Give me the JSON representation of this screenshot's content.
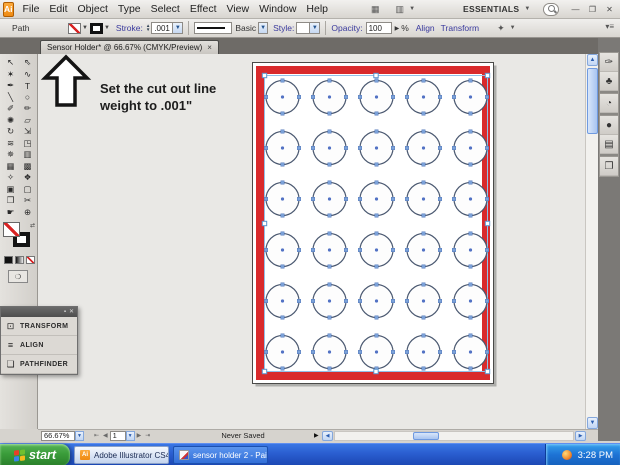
{
  "theme": {
    "chrome": "#d6d3ce",
    "tab_strip": "#6e6b67",
    "canvas_bg": "#e9e8e5",
    "link_purple": "#3a3a9e",
    "taskbar_blue": "#2a5ed0",
    "start_green": "#3a9c3a",
    "artboard_border_red": "#d92a2c",
    "selection_blue": "#92c0e8"
  },
  "window_controls": {
    "minimize": "—",
    "restore": "❐",
    "close": "✕"
  },
  "menu_bar": {
    "logo_text": "Ai",
    "items": [
      "File",
      "Edit",
      "Object",
      "Type",
      "Select",
      "Effect",
      "View",
      "Window",
      "Help"
    ],
    "bridge_icon_glyph": "▦",
    "arrange_icon_glyph": "▥",
    "workspace_label": "ESSENTIALS",
    "caret_glyph": "▼"
  },
  "control_bar": {
    "selection_type_label": "Path",
    "stroke_label": "Stroke:",
    "stroke_weight_value": ".001",
    "brush_name": "Basic",
    "style_label": "Style:",
    "opacity_label": "Opacity:",
    "opacity_value": "100",
    "opacity_arrow": "▶",
    "opacity_unit": "%",
    "align_label": "Align",
    "transform_label": "Transform",
    "select_similar_glyph": "✦",
    "flyout_glyph": "▾≡"
  },
  "document_tab": {
    "title": "Sensor Holder* @ 66.67% (CMYK/Preview)",
    "close_glyph": "×"
  },
  "dock_collapse_glyph": "◄◄",
  "annotation": {
    "line1": "Set the cut out line",
    "line2": "weight to .001\""
  },
  "toolbar": {
    "tools": [
      {
        "name": "selection-tool",
        "glyph": "↖"
      },
      {
        "name": "direct-selection-tool",
        "glyph": "⇖"
      },
      {
        "name": "magic-wand-tool",
        "glyph": "✶"
      },
      {
        "name": "lasso-tool",
        "glyph": "∿"
      },
      {
        "name": "pen-tool",
        "glyph": "✒"
      },
      {
        "name": "type-tool",
        "glyph": "T"
      },
      {
        "name": "line-segment-tool",
        "glyph": "╲"
      },
      {
        "name": "ellipse-tool",
        "glyph": "○"
      },
      {
        "name": "paintbrush-tool",
        "glyph": "✐"
      },
      {
        "name": "pencil-tool",
        "glyph": "✏"
      },
      {
        "name": "blob-brush-tool",
        "glyph": "✺"
      },
      {
        "name": "eraser-tool",
        "glyph": "▱"
      },
      {
        "name": "rotate-tool",
        "glyph": "↻"
      },
      {
        "name": "scale-tool",
        "glyph": "⇲"
      },
      {
        "name": "warp-tool",
        "glyph": "≋"
      },
      {
        "name": "free-transform-tool",
        "glyph": "◳"
      },
      {
        "name": "symbol-sprayer-tool",
        "glyph": "✵"
      },
      {
        "name": "graph-tool",
        "glyph": "▥"
      },
      {
        "name": "mesh-tool",
        "glyph": "▦"
      },
      {
        "name": "gradient-tool",
        "glyph": "▩"
      },
      {
        "name": "eyedropper-tool",
        "glyph": "✧"
      },
      {
        "name": "blend-tool",
        "glyph": "❖"
      },
      {
        "name": "live-paint-bucket-tool",
        "glyph": "▣"
      },
      {
        "name": "live-paint-selection-tool",
        "glyph": "▢"
      },
      {
        "name": "artboard-tool",
        "glyph": "❒"
      },
      {
        "name": "slice-tool",
        "glyph": "✂"
      },
      {
        "name": "hand-tool",
        "glyph": "☛"
      },
      {
        "name": "zoom-tool",
        "glyph": "⊕"
      }
    ]
  },
  "right_dock": {
    "icons": [
      {
        "name": "brushes-icon",
        "glyph": "✑",
        "gap_after": false
      },
      {
        "name": "symbols-icon",
        "glyph": "♣",
        "gap_after": true
      },
      {
        "name": "color-guide-icon",
        "glyph": "◔",
        "gap_after": true
      },
      {
        "name": "color-icon",
        "glyph": "●",
        "gap_after": false
      },
      {
        "name": "swatches-icon",
        "glyph": "▤",
        "gap_after": true
      },
      {
        "name": "layers-icon",
        "glyph": "❐",
        "gap_after": false
      }
    ]
  },
  "floating_panel": {
    "minimize_glyph": "▪",
    "close_glyph": "✕",
    "items": [
      {
        "name": "transform",
        "label": "TRANSFORM",
        "glyph": "⊡"
      },
      {
        "name": "align",
        "label": "ALIGN",
        "glyph": "≡"
      },
      {
        "name": "pathfinder",
        "label": "PATHFINDER",
        "glyph": "❏"
      }
    ]
  },
  "status_bar": {
    "zoom_value": "66.67%",
    "first_glyph": "⇤",
    "prev_glyph": "◀",
    "artboard_value": "1",
    "next_glyph": "▶",
    "last_glyph": "⇥",
    "save_status": "Never Saved",
    "status_flyout_glyph": "▶"
  },
  "artboard": {
    "rows": 6,
    "cols": 5,
    "start_x": 282.5,
    "start_y": 97,
    "dx": 47,
    "dy": 51,
    "radius": 16.5,
    "page": {
      "x": 214.5,
      "y": 8.5,
      "w": 241,
      "h": 321
    },
    "red_rect": {
      "x": 222,
      "y": 16,
      "w": 226,
      "h": 306,
      "stroke_width": 8
    },
    "selection_rect": {
      "x": 226.5,
      "y": 21.5,
      "w": 223,
      "h": 296
    },
    "circle_stroke": "#4a5870",
    "anchor_fill": "#7ca3da",
    "anchor_stroke": "#4f74b8",
    "center_fill": "#5272c4",
    "selection_color": "#92c0e8",
    "handle_stroke": "#5b93cc",
    "border_color": "#d92a2c",
    "page_outline": "#4a4a48"
  },
  "taskbar": {
    "start_label": "start",
    "illustrator_button_label": "Adobe Illustrator CS4...",
    "illustrator_icon_text": "Ai",
    "paint_button_label": "sensor holder 2 - Paint",
    "clock": "3:28 PM"
  }
}
